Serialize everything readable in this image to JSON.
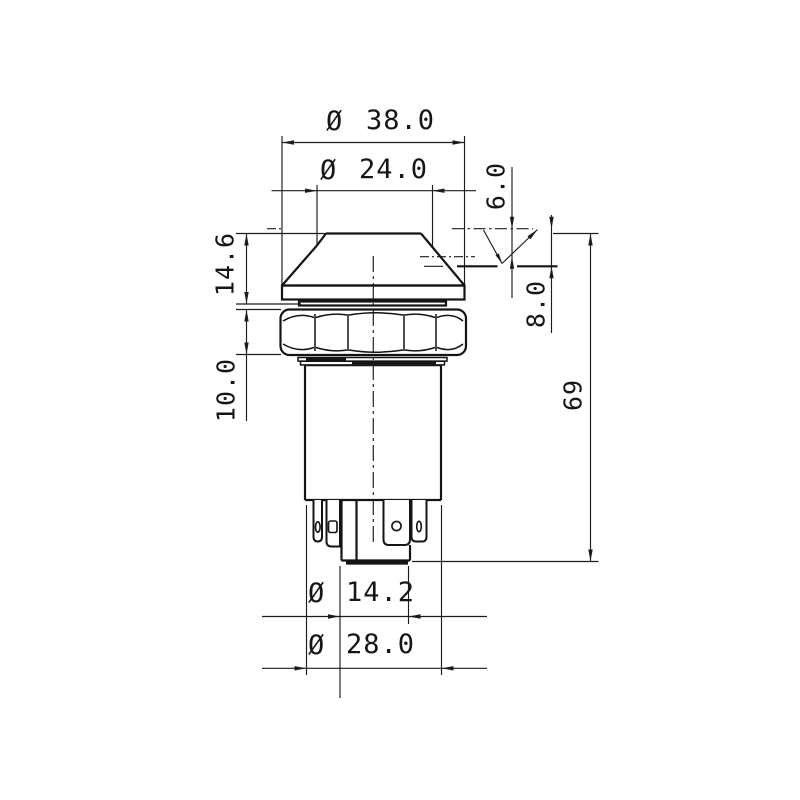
{
  "symbols": {
    "diameter": "Ø"
  },
  "dimensions": {
    "top_diameter": "38.0",
    "button_diameter": "24.0",
    "cap_height": "14.6",
    "nut_height": "10.0",
    "travel_short": "6.0",
    "travel_long": "8.0",
    "overall_height": "69",
    "stub_diameter": "14.2",
    "body_diameter": "28.0"
  },
  "colors": {
    "line": "#141414",
    "background": "#ffffff"
  }
}
